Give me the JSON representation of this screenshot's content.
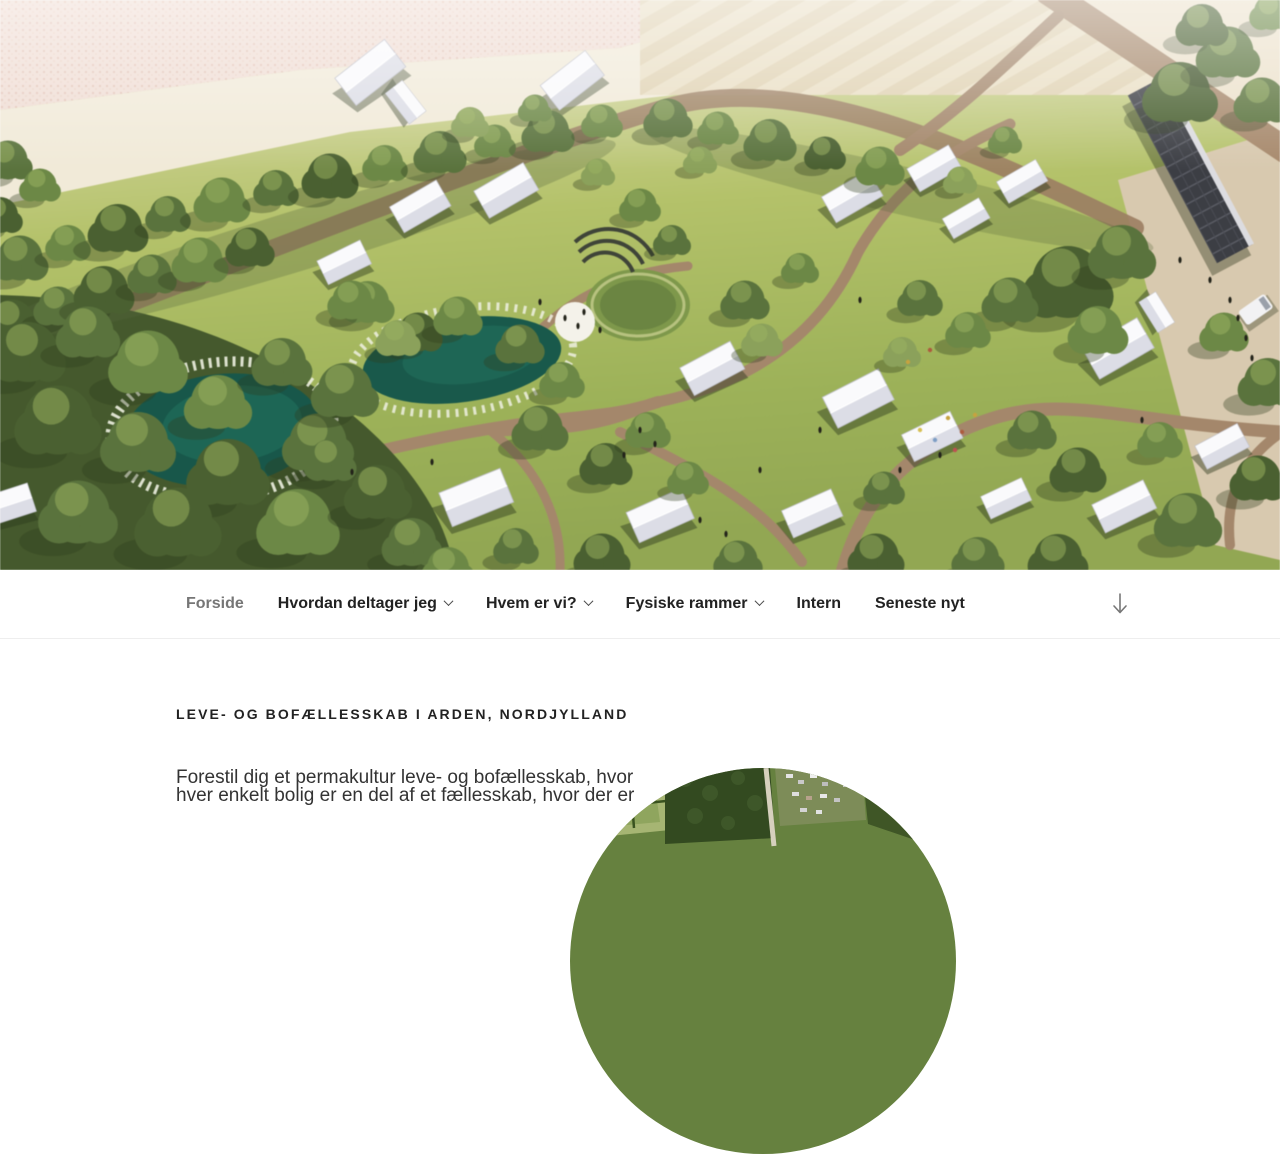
{
  "nav": {
    "items": [
      {
        "label": "Forside",
        "current": true,
        "has_submenu": false
      },
      {
        "label": "Hvordan deltager jeg",
        "current": false,
        "has_submenu": true
      },
      {
        "label": "Hvem er vi?",
        "current": false,
        "has_submenu": true
      },
      {
        "label": "Fysiske rammer",
        "current": false,
        "has_submenu": true
      },
      {
        "label": "Intern",
        "current": false,
        "has_submenu": false
      },
      {
        "label": "Seneste nyt",
        "current": false,
        "has_submenu": false
      }
    ],
    "icons": {
      "dropdown": "chevron-down-icon",
      "scroll": "down-arrow-icon"
    }
  },
  "main": {
    "section_title": "LEVE- OG BOFÆLLESSKAB I ARDEN, NORDJYLLAND",
    "paragraph_line1": "Forestil dig et permakultur leve- og bofællesskab, hvor",
    "paragraph_line2": "hver enkelt bolig er en del af et fællesskab, hvor der er"
  },
  "colors": {
    "nav_text": "#222222",
    "nav_current": "#767676",
    "nav_border": "#eeeeee",
    "heading_text": "#222222",
    "body_text": "#333333",
    "hero_grass": "#a9bc62",
    "hero_pond": "#17594a",
    "hero_field_pink": "#f0ddd4"
  }
}
